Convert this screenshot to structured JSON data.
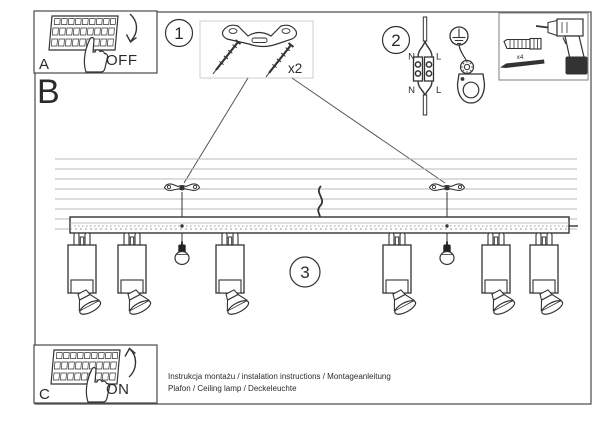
{
  "panel_a": {
    "label": "A",
    "state": "OFF"
  },
  "panel_c": {
    "label": "C",
    "state": "ON"
  },
  "section_b": {
    "label": "B"
  },
  "step1": {
    "number": "1",
    "quantity": "x2"
  },
  "step2": {
    "number": "2",
    "terminal_top_left": "N",
    "terminal_top_right": "L",
    "terminal_bottom_left": "N",
    "terminal_bottom_right": "L"
  },
  "step3": {
    "number": "3"
  },
  "tools": {
    "quantity": "x4"
  },
  "footer": {
    "line1": "Instrukcja montażu / instalation instructions / Montageanleitung",
    "line2": "Plafon / Ceiling lamp / Deckeleuchte"
  },
  "colors": {
    "ink": "#333333",
    "light_line": "#b9b9b9",
    "parts_box_border": "#cfcfcf"
  }
}
